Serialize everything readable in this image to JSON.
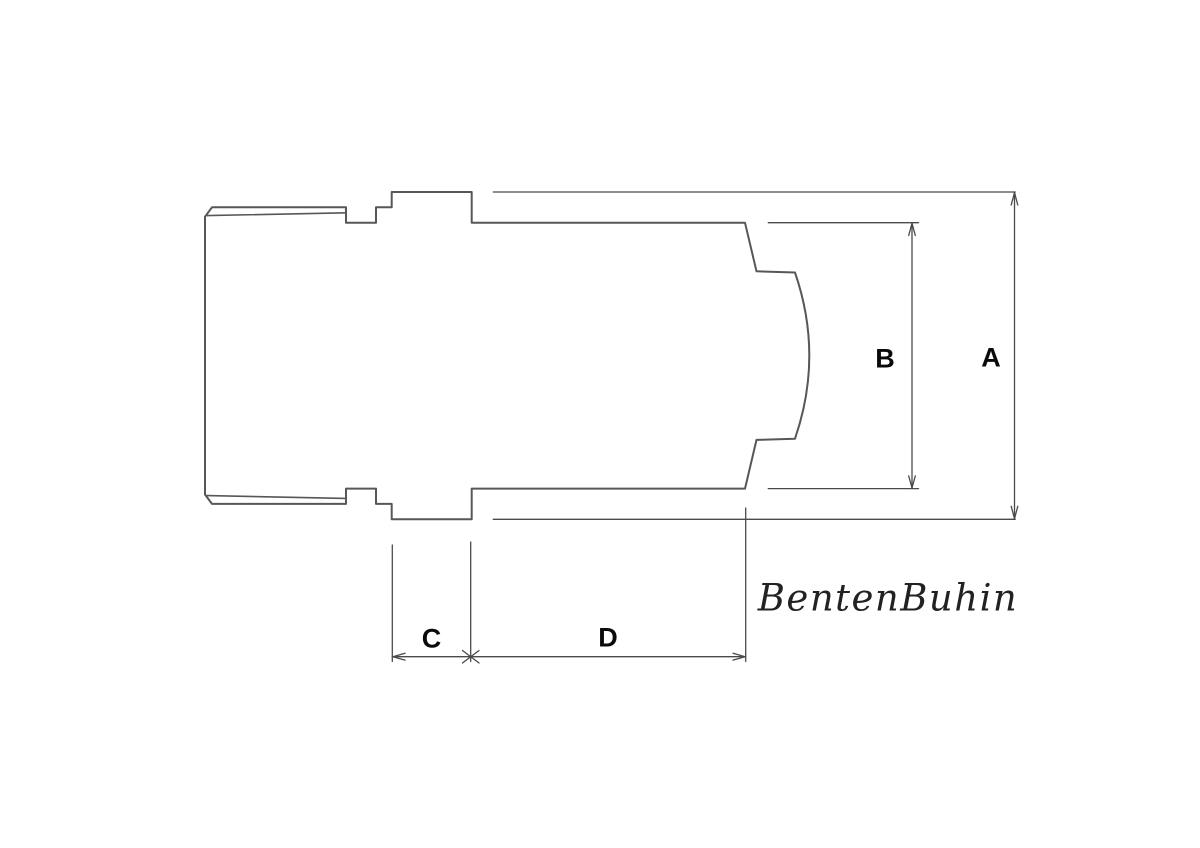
{
  "drawing": {
    "dimension_labels": {
      "a": "A",
      "b": "B",
      "c": "C",
      "d": "D"
    },
    "watermark": "BentenBuhin",
    "colors": {
      "line": "#57575a",
      "dimension_line": "#4a4a4c",
      "label_text": "#0a0a0a",
      "signature_text": "#222222",
      "background": "#ffffff"
    }
  }
}
